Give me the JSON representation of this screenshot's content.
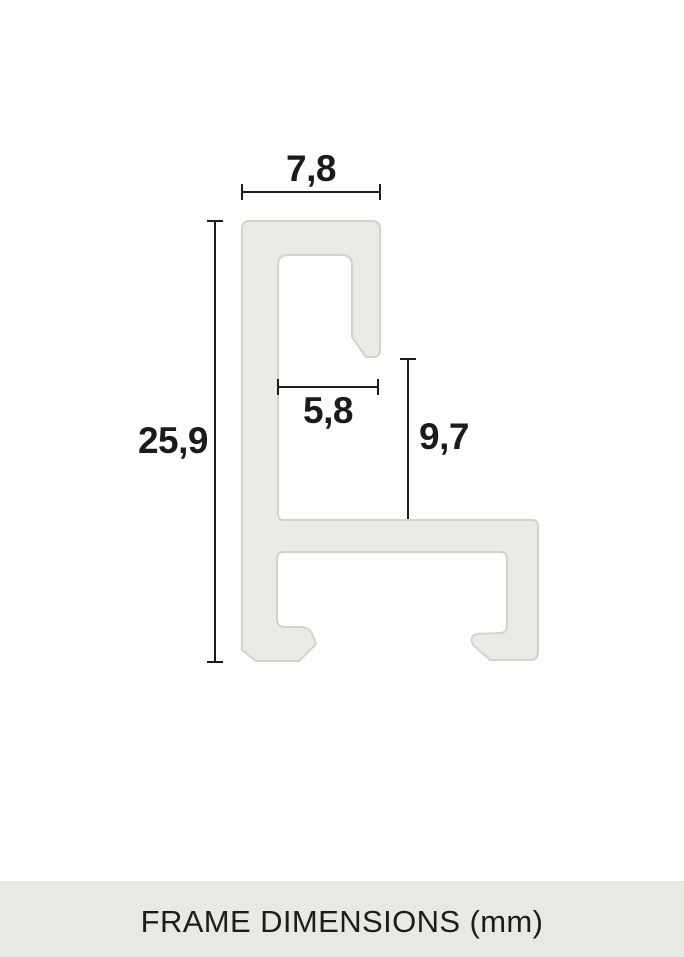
{
  "page": {
    "background": "#fdfdfc"
  },
  "profile": {
    "description": "picture frame aluminium profile cross-section",
    "fill": "#eaeae6",
    "stroke": "#d2d3ce"
  },
  "dimension_style": {
    "line_color": "#1d1d1d",
    "text_color": "#1b1b1b"
  },
  "dimensions": {
    "top_width": {
      "label": "7,8",
      "value_mm": 7.8
    },
    "overall_height": {
      "label": "25,9",
      "value_mm": 25.9
    },
    "rabbet_width": {
      "label": "5,8",
      "value_mm": 5.8
    },
    "rabbet_depth": {
      "label": "9,7",
      "value_mm": 9.7
    }
  },
  "footer": {
    "caption": "FRAME DIMENSIONS (mm)",
    "background": "#e9e9e4"
  },
  "unit": "mm"
}
